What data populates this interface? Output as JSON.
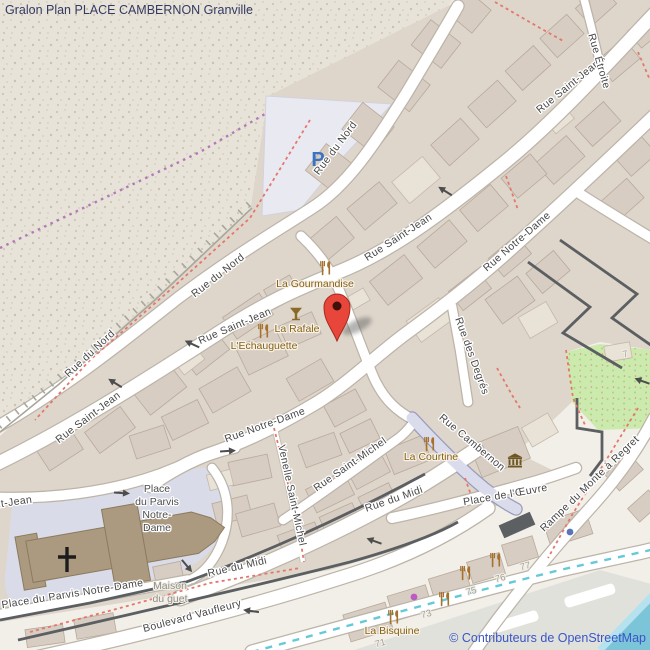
{
  "title": "Gralon Plan PLACE CAMBERNON Granville",
  "attribution": "© Contributeurs de OpenStreetMap",
  "colors": {
    "marker": "#e8463a",
    "water": "#7cc4d8",
    "garden": "#cdeaae",
    "building": "#d7cdc3",
    "road_casing": "#bcb4a8",
    "pedestrian_road": "#dadcec",
    "wall": "#5c5f62",
    "attribution_text": "#3a55c8",
    "title_text": "#333a63",
    "parking_p": "#3b72c1",
    "poi_text": "#876117",
    "cycleway_dash": "#66c9d8",
    "footpath_dash": "#e4776b",
    "boundary_dash": "#b478b8"
  },
  "map": {
    "parking": {
      "label": "P",
      "x": 318,
      "y": 166
    },
    "marker": {
      "x": 337,
      "y": 307
    },
    "streets": [
      {
        "t": "Rue du Nord",
        "x": 92,
        "y": 356,
        "r": -43
      },
      {
        "t": "Rue du Nord",
        "x": 220,
        "y": 278,
        "r": -38
      },
      {
        "t": "Rue du Nord",
        "x": 338,
        "y": 150,
        "r": -53
      },
      {
        "t": "Rue Saint-Jean",
        "x": 90,
        "y": 420,
        "r": -37
      },
      {
        "t": "Rue Saint-Jean",
        "x": 236,
        "y": 329,
        "r": -23
      },
      {
        "t": "Rue Saint-Jean",
        "x": 400,
        "y": 240,
        "r": -33
      },
      {
        "t": "Rue Saint-Jean",
        "x": 570,
        "y": 89,
        "r": -39
      },
      {
        "t": "Rue Saint-Jean",
        "x": -6,
        "y": 508,
        "r": -8
      },
      {
        "t": "Rue Étroite",
        "x": 596,
        "y": 62,
        "r": 74
      },
      {
        "t": "Rue Notre-Dame",
        "x": 519,
        "y": 244,
        "r": -41
      },
      {
        "t": "Rue Notre-Dame",
        "x": 266,
        "y": 428,
        "r": -20
      },
      {
        "t": "Rue des Degrés",
        "x": 469,
        "y": 357,
        "r": 70
      },
      {
        "t": "Rue Cambernon",
        "x": 470,
        "y": 445,
        "r": 40
      },
      {
        "t": "Place de l'Œuvre",
        "x": 506,
        "y": 498,
        "r": -10
      },
      {
        "t": "Rue Saint-Michel",
        "x": 352,
        "y": 467,
        "r": -35
      },
      {
        "t": "Venelle Saint-Michel",
        "x": 289,
        "y": 496,
        "r": 78
      },
      {
        "t": "Rue du Midi",
        "x": 395,
        "y": 502,
        "r": -19
      },
      {
        "t": "Rue du Midi",
        "x": 238,
        "y": 570,
        "r": -13
      },
      {
        "t": "Place du Parvis Notre-Dame",
        "x": 73,
        "y": 597,
        "r": -9
      },
      {
        "t": "Boulevard Vaufleury",
        "x": 193,
        "y": 619,
        "r": -15
      },
      {
        "t": "Rampe du Monte à Regret",
        "x": 592,
        "y": 486,
        "r": -44
      }
    ],
    "pois": [
      {
        "t": "La Gourmandise",
        "x": 315,
        "y": 287
      },
      {
        "t": "La Rafale",
        "x": 297,
        "y": 332
      },
      {
        "t": "L'Echauguette",
        "x": 264,
        "y": 349
      },
      {
        "t": "La Courtine",
        "x": 431,
        "y": 460
      },
      {
        "t": "La Bisquine",
        "x": 392,
        "y": 634
      }
    ],
    "places": [
      {
        "lines": [
          "Place",
          "du Parvis",
          "Notre-",
          "Dame"
        ],
        "x": 157,
        "y": 492,
        "lh": 13,
        "cls": "place-label"
      },
      {
        "lines": [
          "Maison",
          "du guet"
        ],
        "x": 170,
        "y": 589,
        "lh": 13,
        "cls": "muted-label"
      }
    ],
    "house_numbers": [
      {
        "t": "7",
        "x": 626,
        "y": 357
      },
      {
        "t": "71",
        "x": 381,
        "y": 646
      },
      {
        "t": "73",
        "x": 427,
        "y": 617
      },
      {
        "t": "75",
        "x": 472,
        "y": 594
      },
      {
        "t": "76",
        "x": 501,
        "y": 581
      },
      {
        "t": "77",
        "x": 526,
        "y": 569
      }
    ],
    "icons": [
      {
        "k": "restaurant",
        "x": 326,
        "y": 268
      },
      {
        "k": "restaurant",
        "x": 264,
        "y": 331
      },
      {
        "k": "bar",
        "x": 296,
        "y": 314
      },
      {
        "k": "restaurant",
        "x": 430,
        "y": 444
      },
      {
        "k": "restaurant",
        "x": 394,
        "y": 617
      },
      {
        "k": "restaurant",
        "x": 445,
        "y": 599
      },
      {
        "k": "restaurant",
        "x": 466,
        "y": 573
      },
      {
        "k": "restaurant",
        "x": 496,
        "y": 560
      },
      {
        "k": "museum",
        "x": 515,
        "y": 461
      },
      {
        "k": "dot-magenta",
        "x": 414,
        "y": 597
      },
      {
        "k": "dot-blue",
        "x": 570,
        "y": 532
      }
    ],
    "arrows": [
      {
        "x": 115,
        "y": 383,
        "r": 212
      },
      {
        "x": 192,
        "y": 344,
        "r": 205
      },
      {
        "x": 445,
        "y": 191,
        "r": 212
      },
      {
        "x": 228,
        "y": 451,
        "r": -4
      },
      {
        "x": 122,
        "y": 493,
        "r": 4
      },
      {
        "x": 187,
        "y": 566,
        "r": 50
      },
      {
        "x": 374,
        "y": 541,
        "r": 200
      },
      {
        "x": 251,
        "y": 611,
        "r": 188
      },
      {
        "x": 642,
        "y": 381,
        "r": 200
      }
    ]
  }
}
